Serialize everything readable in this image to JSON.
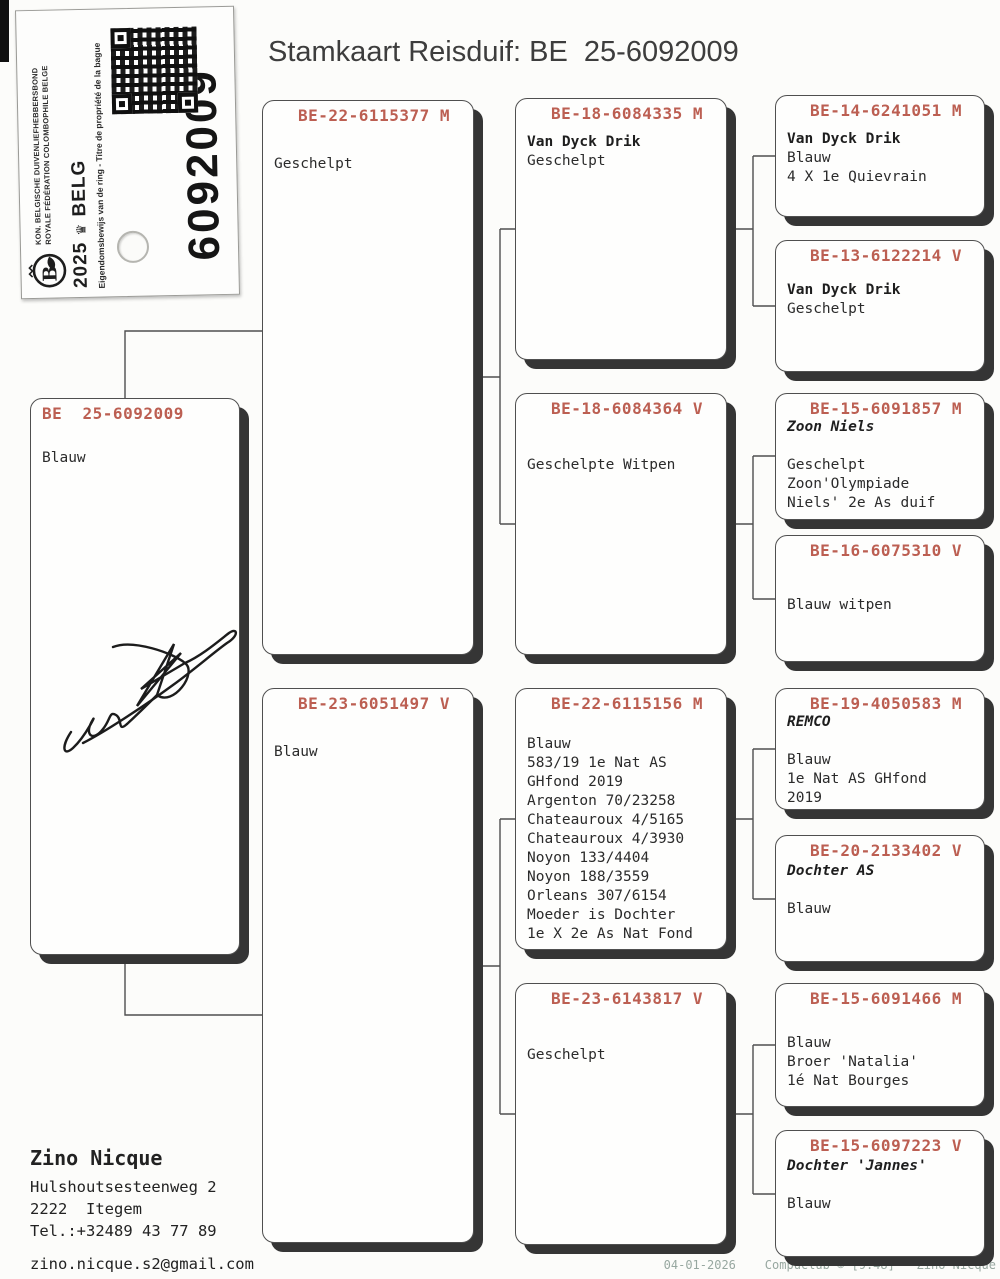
{
  "title": "Stamkaart Reisduif: BE  25-6092009",
  "accent_color": "#bc5f52",
  "sticker": {
    "federation_line1": "KON. BELGISCHE DUIVENLIEFHEBBERSBOND",
    "federation_line2": "ROYALE FÉDÉRATION COLOMBOPHILE BELGE",
    "year": "2025",
    "country": "BELG",
    "ownership_text": "Eigendomsbewijs van de ring - Titre de propriété de la bague",
    "ring_number": "6092009",
    "qr_label": "qr-code"
  },
  "subject": {
    "ring": "BE  25-6092009",
    "lines": [
      "Blauw"
    ]
  },
  "generation2": [
    {
      "ring": "BE-22-6115377 M",
      "lines": [
        "Geschelpt"
      ]
    },
    {
      "ring": "BE-23-6051497 V",
      "lines": [
        "Blauw"
      ]
    }
  ],
  "generation3": [
    {
      "ring": "BE-18-6084335 M",
      "name": "Van Dyck Drik",
      "lines": [
        "Geschelpt"
      ]
    },
    {
      "ring": "BE-18-6084364 V",
      "lines": [
        "Geschelpte Witpen"
      ]
    },
    {
      "ring": "BE-22-6115156 M",
      "lines": [
        "Blauw",
        "583/19 1e Nat AS",
        "GHfond 2019",
        "Argenton 70/23258",
        "Chateauroux 4/5165",
        "Chateauroux 4/3930",
        "Noyon 133/4404",
        "Noyon 188/3559",
        "Orleans 307/6154",
        "Moeder is Dochter",
        "1e X 2e As Nat Fond"
      ]
    },
    {
      "ring": "BE-23-6143817 V",
      "lines": [
        "Geschelpt"
      ]
    }
  ],
  "generation4": [
    {
      "ring": "BE-14-6241051 M",
      "name": "Van Dyck Drik",
      "lines": [
        "Blauw",
        "4 X 1e Quievrain"
      ]
    },
    {
      "ring": "BE-13-6122214 V",
      "name": "Van Dyck Drik",
      "lines": [
        "Geschelpt"
      ]
    },
    {
      "ring": "BE-15-6091857 M",
      "name": "Zoon Niels",
      "lines": [
        "",
        "Geschelpt",
        "Zoon'Olympiade",
        "Niels' 2e As duif"
      ]
    },
    {
      "ring": "BE-16-6075310 V",
      "lines": [
        "Blauw witpen"
      ]
    },
    {
      "ring": "BE-19-4050583 M",
      "name": "REMCO",
      "lines": [
        "",
        "Blauw",
        "1e Nat AS GHfond",
        "2019"
      ]
    },
    {
      "ring": "BE-20-2133402 V",
      "name": "Dochter AS",
      "lines": [
        "",
        "Blauw"
      ]
    },
    {
      "ring": "BE-15-6091466 M",
      "lines": [
        "Blauw",
        "Broer 'Natalia'",
        "1é Nat Bourges"
      ]
    },
    {
      "ring": "BE-15-6097223 V",
      "name": "Dochter 'Jannes'",
      "lines": [
        "",
        "Blauw"
      ]
    }
  ],
  "owner": {
    "name": "Zino Nicque",
    "address1": "Hulshoutsesteenweg 2",
    "address2": "2222  Itegem",
    "phone": "Tel.:+32489 43 77 89",
    "email": "zino.nicque.s2@gmail.com",
    "names": "Zino & Stephany Nicque"
  },
  "footer": "04-01-2026    Compuclub © [9.48]   Zino Nicque"
}
